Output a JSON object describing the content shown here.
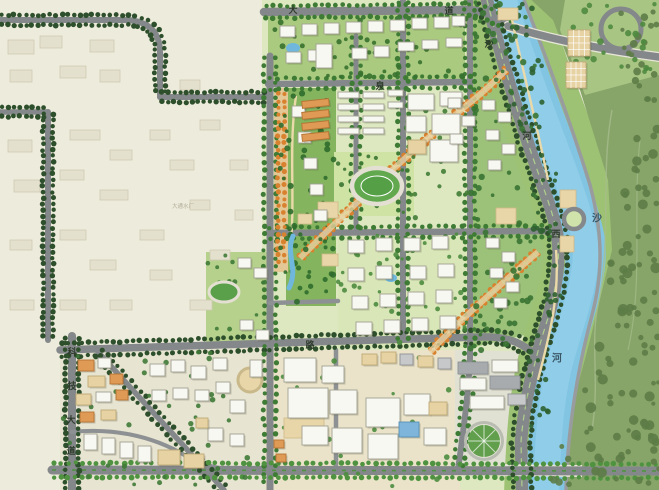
{
  "map": {
    "type": "urban-master-plan",
    "river": {
      "name": "沙河",
      "labels": [
        {
          "t": "沙",
          "x": 597,
          "y": 218
        },
        {
          "t": "河",
          "x": 557,
          "y": 358
        }
      ]
    },
    "named_roads": [
      "科技大道",
      "沙河西路"
    ],
    "road_labels": [
      {
        "t": "大",
        "x": 293,
        "y": 10
      },
      {
        "t": "道",
        "x": 449,
        "y": 11
      },
      {
        "t": "泉",
        "x": 380,
        "y": 86
      },
      {
        "t": "路",
        "x": 310,
        "y": 345
      },
      {
        "t": "沙",
        "x": 489,
        "y": 44
      },
      {
        "t": "河",
        "x": 527,
        "y": 136
      },
      {
        "t": "西",
        "x": 556,
        "y": 234
      },
      {
        "t": "科",
        "x": 72,
        "y": 352
      },
      {
        "t": "技",
        "x": 72,
        "y": 386
      },
      {
        "t": "大",
        "x": 71,
        "y": 420
      },
      {
        "t": "道",
        "x": 71,
        "y": 451
      }
    ],
    "area_labels": [
      {
        "t": "大通水厂",
        "x": 183,
        "y": 206
      }
    ],
    "colors": {
      "base": "#edebdb",
      "plan": "#dde7c0",
      "devSW": "#e7e4d1",
      "commercial": "#eae3c9",
      "seRight": "#e1e1d3",
      "eastBank": "#87a569",
      "cornerPark": "#a9c584",
      "riverBand": "#9dc274",
      "ridge": "#9cc178",
      "topRes": "#aacb7f",
      "centralPark": "#84b55e",
      "field": "#cfe3a4",
      "midRes": "#d9e6b8",
      "pocket": "#b5d18c",
      "river": "#82c5e3",
      "riverHi": "#95d0ea",
      "road": "#85888a",
      "roadMinor": "#8e9193",
      "treeDark": "#2d4f2b",
      "tree": "#3e7b35",
      "treeBright": "#4f9340",
      "treeOrange": "#d8812e",
      "clump": "#5d7c47",
      "white": "#f8f8f3",
      "whiteStroke": "#a0a092",
      "tan": "#e6d2a2",
      "tanStroke": "#bfa977",
      "orange": "#df9a55",
      "orangeStroke": "#b57433",
      "gray": "#c6c8ca",
      "grayStroke": "#8f9295",
      "dark": "#a7abae",
      "blue": "#7fb5da",
      "blueStroke": "#5890b4",
      "ghost": "#e3e0cd",
      "ghostStroke": "#cfcab3",
      "plaza": "#e8d6a8",
      "labelRoad": "#2e3b2c",
      "labelRiver": "#3a5666",
      "labelArea": "#b3ae9c",
      "pathTan": "#ead9a9",
      "water": "#6fb7dd"
    },
    "buildings": {
      "white": [
        [
          280,
          26,
          15,
          11
        ],
        [
          302,
          24,
          15,
          11
        ],
        [
          324,
          23,
          15,
          11
        ],
        [
          346,
          22,
          15,
          11
        ],
        [
          368,
          21,
          15,
          11
        ],
        [
          390,
          20,
          15,
          11
        ],
        [
          412,
          18,
          15,
          11
        ],
        [
          434,
          17,
          15,
          11
        ],
        [
          452,
          16,
          13,
          10
        ],
        [
          286,
          52,
          15,
          11
        ],
        [
          308,
          50,
          15,
          11
        ],
        [
          352,
          48,
          15,
          11
        ],
        [
          374,
          46,
          15,
          11
        ],
        [
          398,
          42,
          16,
          9
        ],
        [
          422,
          40,
          16,
          9
        ],
        [
          446,
          38,
          16,
          9
        ],
        [
          316,
          44,
          16,
          24
        ],
        [
          338,
          92,
          21,
          6
        ],
        [
          363,
          92,
          21,
          6
        ],
        [
          388,
          90,
          15,
          6
        ],
        [
          338,
          104,
          21,
          6
        ],
        [
          363,
          104,
          21,
          6
        ],
        [
          388,
          102,
          15,
          6
        ],
        [
          338,
          116,
          21,
          6
        ],
        [
          363,
          116,
          21,
          6
        ],
        [
          338,
          128,
          21,
          6
        ],
        [
          363,
          128,
          21,
          6
        ],
        [
          408,
          94,
          26,
          16
        ],
        [
          440,
          92,
          22,
          14
        ],
        [
          406,
          116,
          20,
          16
        ],
        [
          432,
          114,
          28,
          20
        ],
        [
          430,
          140,
          28,
          22
        ],
        [
          292,
          106,
          13,
          11
        ],
        [
          298,
          132,
          13,
          11
        ],
        [
          304,
          158,
          13,
          11
        ],
        [
          310,
          184,
          13,
          11
        ],
        [
          314,
          210,
          13,
          11
        ],
        [
          348,
          240,
          16,
          13
        ],
        [
          376,
          238,
          16,
          13
        ],
        [
          404,
          238,
          16,
          13
        ],
        [
          432,
          236,
          16,
          13
        ],
        [
          348,
          268,
          16,
          13
        ],
        [
          376,
          266,
          16,
          13
        ],
        [
          410,
          266,
          16,
          13
        ],
        [
          438,
          264,
          16,
          13
        ],
        [
          352,
          296,
          16,
          13
        ],
        [
          380,
          294,
          16,
          13
        ],
        [
          408,
          292,
          16,
          13
        ],
        [
          436,
          290,
          16,
          13
        ],
        [
          356,
          322,
          16,
          13
        ],
        [
          384,
          320,
          16,
          13
        ],
        [
          412,
          318,
          16,
          13
        ],
        [
          440,
          316,
          16,
          13
        ],
        [
          448,
          98,
          13,
          10
        ],
        [
          462,
          116,
          13,
          10
        ],
        [
          450,
          134,
          13,
          10
        ],
        [
          482,
          100,
          13,
          10
        ],
        [
          498,
          112,
          13,
          10
        ],
        [
          486,
          130,
          13,
          10
        ],
        [
          502,
          144,
          13,
          10
        ],
        [
          488,
          160,
          13,
          10
        ],
        [
          486,
          238,
          13,
          10
        ],
        [
          502,
          252,
          13,
          10
        ],
        [
          490,
          268,
          13,
          10
        ],
        [
          506,
          282,
          13,
          10
        ],
        [
          494,
          298,
          13,
          10
        ],
        [
          238,
          258,
          13,
          10
        ],
        [
          254,
          268,
          13,
          10
        ],
        [
          240,
          320,
          13,
          10
        ],
        [
          256,
          330,
          13,
          10
        ],
        [
          98,
          358,
          13,
          10
        ],
        [
          96,
          392,
          15,
          10
        ],
        [
          84,
          434,
          13,
          16
        ],
        [
          102,
          438,
          13,
          16
        ],
        [
          120,
          442,
          13,
          16
        ],
        [
          138,
          446,
          13,
          16
        ],
        [
          150,
          364,
          15,
          12
        ],
        [
          171,
          360,
          14,
          12
        ],
        [
          191,
          366,
          15,
          13
        ],
        [
          213,
          358,
          14,
          12
        ],
        [
          152,
          390,
          14,
          11
        ],
        [
          173,
          388,
          15,
          11
        ],
        [
          195,
          390,
          14,
          11
        ],
        [
          216,
          382,
          14,
          11
        ],
        [
          230,
          400,
          15,
          13
        ],
        [
          208,
          428,
          15,
          13
        ],
        [
          230,
          434,
          14,
          12
        ],
        [
          250,
          360,
          12,
          17
        ],
        [
          284,
          358,
          32,
          24
        ],
        [
          288,
          388,
          40,
          30
        ],
        [
          322,
          366,
          22,
          17
        ],
        [
          330,
          390,
          27,
          24
        ],
        [
          302,
          426,
          26,
          19
        ],
        [
          332,
          428,
          30,
          25
        ],
        [
          366,
          398,
          34,
          29
        ],
        [
          368,
          434,
          30,
          25
        ],
        [
          404,
          394,
          26,
          21
        ],
        [
          424,
          428,
          22,
          17
        ],
        [
          492,
          360,
          26,
          12
        ],
        [
          460,
          378,
          26,
          12
        ],
        [
          470,
          396,
          34,
          13
        ]
      ],
      "tan": [
        [
          88,
          376,
          17,
          11
        ],
        [
          76,
          394,
          15,
          11
        ],
        [
          101,
          410,
          15,
          10
        ],
        [
          158,
          450,
          22,
          15
        ],
        [
          184,
          454,
          20,
          14
        ],
        [
          196,
          418,
          12,
          10
        ],
        [
          429,
          402,
          18,
          13
        ],
        [
          362,
          354,
          15,
          11
        ],
        [
          381,
          352,
          15,
          11
        ],
        [
          418,
          356,
          15,
          11
        ],
        [
          568,
          30,
          22,
          26
        ],
        [
          566,
          62,
          20,
          26
        ],
        [
          408,
          140,
          18,
          14
        ]
      ],
      "orange": [
        [
          78,
          360,
          16,
          11
        ],
        [
          110,
          374,
          13,
          10
        ],
        [
          116,
          390,
          12,
          10
        ],
        [
          80,
          412,
          14,
          10
        ],
        [
          274,
          440,
          10,
          8
        ],
        [
          276,
          454,
          10,
          8
        ],
        [
          302,
          100,
          27,
          7,
          -6
        ],
        [
          302,
          111,
          27,
          7,
          -6
        ],
        [
          302,
          122,
          27,
          7,
          -6
        ],
        [
          302,
          133,
          27,
          7,
          -6
        ]
      ],
      "gray": [
        [
          400,
          354,
          13,
          11
        ],
        [
          438,
          358,
          13,
          11
        ],
        [
          508,
          394,
          18,
          11
        ]
      ],
      "dark": [
        [
          458,
          362,
          30,
          12
        ],
        [
          490,
          376,
          30,
          13
        ]
      ],
      "blue": [
        [
          399,
          422,
          20,
          15
        ]
      ],
      "ghost": [
        [
          8,
          40,
          26,
          14
        ],
        [
          40,
          36,
          22,
          12
        ],
        [
          90,
          40,
          24,
          12
        ],
        [
          10,
          70,
          22,
          12
        ],
        [
          60,
          66,
          26,
          12
        ],
        [
          100,
          70,
          20,
          12
        ],
        [
          8,
          140,
          24,
          12
        ],
        [
          70,
          130,
          30,
          10
        ],
        [
          110,
          150,
          22,
          10
        ],
        [
          14,
          180,
          26,
          12
        ],
        [
          60,
          170,
          24,
          10
        ],
        [
          100,
          190,
          28,
          10
        ],
        [
          140,
          230,
          24,
          10
        ],
        [
          60,
          230,
          26,
          10
        ],
        [
          10,
          240,
          22,
          10
        ],
        [
          90,
          260,
          26,
          10
        ],
        [
          150,
          270,
          22,
          10
        ],
        [
          10,
          300,
          24,
          10
        ],
        [
          60,
          300,
          26,
          10
        ],
        [
          110,
          300,
          22,
          10
        ],
        [
          150,
          130,
          20,
          10
        ],
        [
          180,
          80,
          20,
          10
        ],
        [
          200,
          120,
          20,
          10
        ],
        [
          170,
          160,
          24,
          10
        ],
        [
          190,
          200,
          20,
          10
        ],
        [
          210,
          250,
          20,
          10
        ],
        [
          190,
          300,
          22,
          10
        ],
        [
          230,
          160,
          18,
          10
        ],
        [
          235,
          210,
          18,
          10
        ]
      ]
    },
    "features": {
      "plazas": [
        [
          318,
          202,
          20,
          16
        ],
        [
          298,
          214,
          14,
          10
        ],
        [
          322,
          254,
          16,
          12
        ],
        [
          560,
          190,
          16,
          18
        ],
        [
          560,
          236,
          14,
          16
        ],
        [
          498,
          8,
          20,
          12
        ],
        [
          496,
          208,
          20,
          16
        ],
        [
          284,
          418,
          40,
          20
        ]
      ],
      "pools": [
        {
          "cx": 293,
          "cy": 48,
          "rx": 7,
          "ry": 5
        },
        {
          "cx": 391,
          "cy": 278,
          "rx": 6,
          "ry": 4
        }
      ],
      "track": {
        "cx": 377,
        "cy": 186,
        "rx": 25,
        "ry": 18
      },
      "mini_track": {
        "cx": 224,
        "cy": 292,
        "rx": 15,
        "ry": 10
      },
      "garden_circle": {
        "cx": 484,
        "cy": 441,
        "r": 16
      },
      "roundabout": {
        "cx": 574,
        "cy": 219,
        "r": 10
      },
      "ramp_loop": {
        "cx": 621,
        "cy": 29,
        "r": 20
      }
    }
  }
}
